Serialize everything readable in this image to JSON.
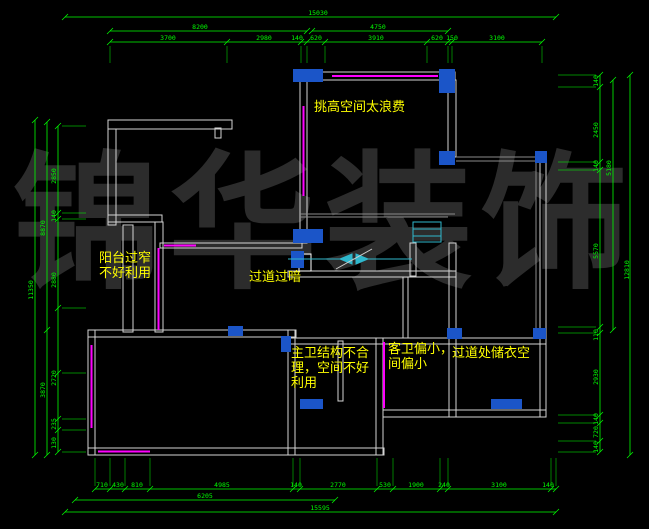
{
  "title": "floor-plan-cad-view",
  "watermark": {
    "text": "锦华装饰",
    "color": "#2c2c2c"
  },
  "colors": {
    "background": "#000000",
    "dimension": "#00ff00",
    "wall": "#d4d4d4",
    "thin_line": "#8a8a8a",
    "window": "#ff00ff",
    "column": "#1b55c8",
    "stair": "#2fb8cd",
    "annotation": "#ffff00"
  },
  "annotations": [
    {
      "id": "note-tall-space",
      "lines": [
        "挑高空间太浪费"
      ],
      "x": 314,
      "y": 101
    },
    {
      "id": "note-balcony",
      "lines": [
        "阳台过窄",
        "不好利用"
      ],
      "x": 99,
      "y": 252
    },
    {
      "id": "note-corridor-dark",
      "lines": [
        "过道过暗"
      ],
      "x": 249,
      "y": 271
    },
    {
      "id": "note-master-bath",
      "lines": [
        "主卫结构不合",
        "理，空间不好",
        "利用"
      ],
      "x": 291,
      "y": 347
    },
    {
      "id": "note-guest-bath",
      "lines": [
        "客卫偏小，",
        "间偏小"
      ],
      "x": 388,
      "y": 343
    },
    {
      "id": "note-closet",
      "lines": [
        "过道处储衣空"
      ],
      "x": 452,
      "y": 347
    }
  ],
  "dim_labels": [
    {
      "text": "15030",
      "x": 318,
      "y": 15,
      "rot": 0
    },
    {
      "text": "8200",
      "x": 200,
      "y": 29,
      "rot": 0
    },
    {
      "text": "4750",
      "x": 378,
      "y": 29,
      "rot": 0
    },
    {
      "text": "3700",
      "x": 168,
      "y": 40,
      "rot": 0
    },
    {
      "text": "2980",
      "x": 264,
      "y": 40,
      "rot": 0
    },
    {
      "text": "140",
      "x": 297,
      "y": 40,
      "rot": 0
    },
    {
      "text": "620",
      "x": 316,
      "y": 40,
      "rot": 0
    },
    {
      "text": "3910",
      "x": 376,
      "y": 40,
      "rot": 0
    },
    {
      "text": "620",
      "x": 437,
      "y": 40,
      "rot": 0
    },
    {
      "text": "150",
      "x": 452,
      "y": 40,
      "rot": 0
    },
    {
      "text": "3100",
      "x": 497,
      "y": 40,
      "rot": 0
    },
    {
      "text": "710",
      "x": 102,
      "y": 487,
      "rot": 0
    },
    {
      "text": "430",
      "x": 118,
      "y": 487,
      "rot": 0
    },
    {
      "text": "810",
      "x": 137,
      "y": 487,
      "rot": 0
    },
    {
      "text": "4985",
      "x": 222,
      "y": 487,
      "rot": 0
    },
    {
      "text": "140",
      "x": 296,
      "y": 487,
      "rot": 0
    },
    {
      "text": "2770",
      "x": 338,
      "y": 487,
      "rot": 0
    },
    {
      "text": "530",
      "x": 385,
      "y": 487,
      "rot": 0
    },
    {
      "text": "1900",
      "x": 416,
      "y": 487,
      "rot": 0
    },
    {
      "text": "240",
      "x": 444,
      "y": 487,
      "rot": 0
    },
    {
      "text": "3100",
      "x": 499,
      "y": 487,
      "rot": 0
    },
    {
      "text": "140",
      "x": 548,
      "y": 487,
      "rot": 0
    },
    {
      "text": "6205",
      "x": 205,
      "y": 498,
      "rot": 0
    },
    {
      "text": "15595",
      "x": 320,
      "y": 510,
      "rot": 0
    },
    {
      "text": "11350",
      "x": 33,
      "y": 290,
      "rot": -90
    },
    {
      "text": "8870",
      "x": 45,
      "y": 228,
      "rot": -90
    },
    {
      "text": "3870",
      "x": 45,
      "y": 390,
      "rot": -90
    },
    {
      "text": "2850",
      "x": 56,
      "y": 176,
      "rot": -90
    },
    {
      "text": "140",
      "x": 56,
      "y": 216,
      "rot": -90
    },
    {
      "text": "2880",
      "x": 56,
      "y": 280,
      "rot": -90
    },
    {
      "text": "2720",
      "x": 56,
      "y": 378,
      "rot": -90
    },
    {
      "text": "235",
      "x": 56,
      "y": 424,
      "rot": -90
    },
    {
      "text": "130",
      "x": 56,
      "y": 443,
      "rot": -90
    },
    {
      "text": "140",
      "x": 598,
      "y": 81,
      "rot": -90
    },
    {
      "text": "2450",
      "x": 598,
      "y": 130,
      "rot": -90
    },
    {
      "text": "140",
      "x": 598,
      "y": 166,
      "rot": -90
    },
    {
      "text": "5570",
      "x": 598,
      "y": 251,
      "rot": -90
    },
    {
      "text": "110",
      "x": 598,
      "y": 335,
      "rot": -90
    },
    {
      "text": "2930",
      "x": 598,
      "y": 377,
      "rot": -90
    },
    {
      "text": "140",
      "x": 598,
      "y": 419,
      "rot": -90
    },
    {
      "text": "720",
      "x": 598,
      "y": 432,
      "rot": -90
    },
    {
      "text": "140",
      "x": 598,
      "y": 447,
      "rot": -90
    },
    {
      "text": "5180",
      "x": 611,
      "y": 168,
      "rot": -90
    },
    {
      "text": "12810",
      "x": 629,
      "y": 270,
      "rot": -90
    }
  ]
}
